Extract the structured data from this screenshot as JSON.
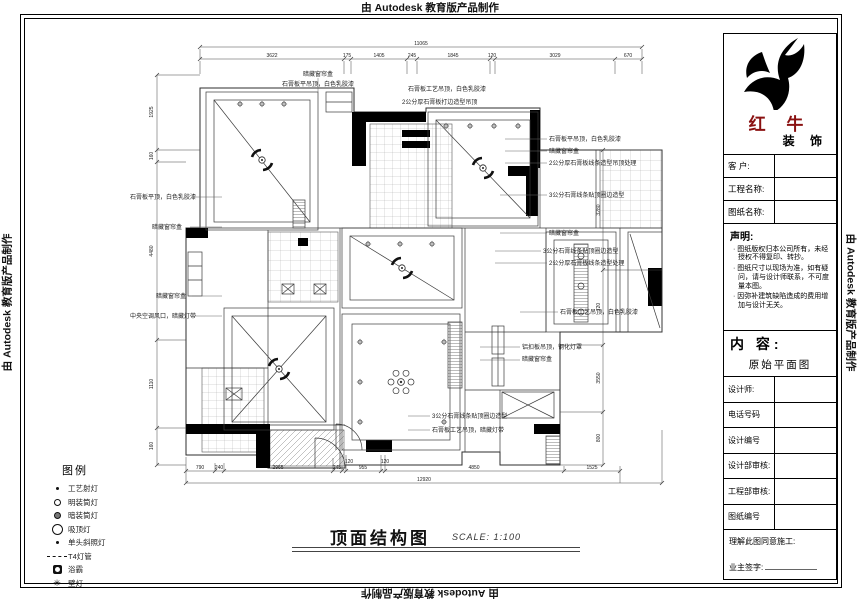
{
  "edge_banner": {
    "text": "由 Autodesk 教育版产品制作"
  },
  "colors": {
    "brand_red": "#8a1111",
    "line": "#3a3a3a",
    "wall": "#000000"
  },
  "title_block": {
    "brand": {
      "name_line1": "红 牛",
      "name_line2": "装 饰"
    },
    "fields": [
      {
        "label": "客  户:"
      },
      {
        "label": "工程名称:"
      },
      {
        "label": "图纸名称:"
      }
    ],
    "statement": {
      "heading": "声明:",
      "items": [
        "图纸版权归本公司所有，未经授权不得复印、转抄。",
        "图纸尺寸以现场为准，如有疑问，请与设计师联系，不可度量本图。",
        "因弥补建筑缺陷造成的费用增加与设计无关。"
      ]
    },
    "content": {
      "heading": "内 容:",
      "value": "原始平面图"
    },
    "rows": [
      "设计师:",
      "电话号码",
      "设计编号",
      "设计部审核:",
      "工程部审核:",
      "图纸编号"
    ],
    "footer": {
      "line1": "理解此图同意施工:",
      "line2": "业主签字:"
    }
  },
  "legend": {
    "title": "图例",
    "items": [
      {
        "icon": "i-dot",
        "label": "工艺射灯"
      },
      {
        "icon": "i-circ",
        "label": "明装筒灯"
      },
      {
        "icon": "i-circ2",
        "label": "暗装筒灯"
      },
      {
        "icon": "i-big",
        "label": "吸顶灯"
      },
      {
        "icon": "i-dot",
        "label": "单头斜照灯"
      },
      {
        "icon": "i-dashdot",
        "label": "T4灯管"
      },
      {
        "icon": "i-fan",
        "label": "浴霸"
      },
      {
        "icon": "i-star",
        "label": "壁灯",
        "glyph": "✳"
      }
    ]
  },
  "drawing_title": {
    "text": "顶面结构图",
    "scale": "SCALE: 1:100"
  },
  "drawing": {
    "texts": [
      {
        "t": "暗藏窗帘盒",
        "x": 318,
        "y": 76,
        "a": "middle"
      },
      {
        "t": "石膏板平吊顶，白色乳胶漆",
        "x": 282,
        "y": 86
      },
      {
        "t": "石膏板工艺吊顶，白色乳胶漆",
        "x": 408,
        "y": 91
      },
      {
        "t": "2公分厚石膏板打边造型吊顶",
        "x": 402,
        "y": 104
      },
      {
        "t": "石膏板平吊顶，白色乳胶漆",
        "x": 549,
        "y": 141
      },
      {
        "t": "暗藏窗帘盒",
        "x": 549,
        "y": 153
      },
      {
        "t": "2公分厚石膏板线条造型吊顶处理",
        "x": 549,
        "y": 165
      },
      {
        "t": "3公分石膏线条贴顶圈边造型",
        "x": 549,
        "y": 197
      },
      {
        "t": "暗藏窗帘盒",
        "x": 549,
        "y": 235
      },
      {
        "t": "3公分石膏线条贴顶圈边造型",
        "x": 543,
        "y": 253
      },
      {
        "t": "2公分厚石膏板线条造型处理",
        "x": 549,
        "y": 265
      },
      {
        "t": "石膏板工艺吊顶，白色乳胶漆",
        "x": 560,
        "y": 314
      },
      {
        "t": "铝扣板吊顶，钢化灯罩",
        "x": 522,
        "y": 349
      },
      {
        "t": "暗藏窗帘盒",
        "x": 522,
        "y": 361
      },
      {
        "t": "石膏板平顶，白色乳胶漆",
        "x": 130,
        "y": 199
      },
      {
        "t": "暗藏窗帘盒",
        "x": 152,
        "y": 229
      },
      {
        "t": "暗藏窗帘盒",
        "x": 156,
        "y": 298
      },
      {
        "t": "中央空调风口，暗藏灯带",
        "x": 130,
        "y": 318
      },
      {
        "t": "3公分石膏线条贴顶圈边造型",
        "x": 432,
        "y": 418
      },
      {
        "t": "石膏板工艺吊顶，暗藏灯带",
        "x": 432,
        "y": 432
      },
      {
        "t": "11065",
        "x": 421,
        "y": 45,
        "s": 5,
        "a": "middle",
        "n": "dim-label"
      },
      {
        "t": "3622",
        "x": 272,
        "y": 57,
        "s": 5,
        "a": "middle",
        "n": "dim-label"
      },
      {
        "t": "175",
        "x": 347,
        "y": 57,
        "s": 5,
        "a": "middle",
        "n": "dim-label"
      },
      {
        "t": "1405",
        "x": 379,
        "y": 57,
        "s": 5,
        "a": "middle",
        "n": "dim-label"
      },
      {
        "t": "245",
        "x": 412,
        "y": 57,
        "s": 5,
        "a": "middle",
        "n": "dim-label"
      },
      {
        "t": "1845",
        "x": 453,
        "y": 57,
        "s": 5,
        "a": "middle",
        "n": "dim-label"
      },
      {
        "t": "120",
        "x": 492,
        "y": 57,
        "s": 5,
        "a": "middle",
        "n": "dim-label"
      },
      {
        "t": "3029",
        "x": 555,
        "y": 57,
        "s": 5,
        "a": "middle",
        "n": "dim-label"
      },
      {
        "t": "670",
        "x": 628,
        "y": 57,
        "s": 5,
        "a": "middle",
        "n": "dim-label"
      },
      {
        "t": "790",
        "x": 200,
        "y": 469,
        "s": 5,
        "a": "middle",
        "n": "dim-label"
      },
      {
        "t": "240",
        "x": 219,
        "y": 469,
        "s": 5,
        "a": "middle",
        "n": "dim-label"
      },
      {
        "t": "2965",
        "x": 278,
        "y": 469,
        "s": 5,
        "a": "middle",
        "n": "dim-label"
      },
      {
        "t": "245",
        "x": 337,
        "y": 469,
        "s": 5,
        "a": "middle",
        "n": "dim-label"
      },
      {
        "t": "120",
        "x": 349,
        "y": 463,
        "s": 5,
        "a": "middle",
        "n": "dim-label"
      },
      {
        "t": "955",
        "x": 363,
        "y": 469,
        "s": 5,
        "a": "middle",
        "n": "dim-label"
      },
      {
        "t": "120",
        "x": 385,
        "y": 463,
        "s": 5,
        "a": "middle",
        "n": "dim-label"
      },
      {
        "t": "4850",
        "x": 474,
        "y": 469,
        "s": 5,
        "a": "middle",
        "n": "dim-label"
      },
      {
        "t": "1525",
        "x": 592,
        "y": 469,
        "s": 5,
        "a": "middle",
        "n": "dim-label"
      },
      {
        "t": "12920",
        "x": 424,
        "y": 481,
        "s": 5,
        "a": "middle",
        "n": "dim-label"
      },
      {
        "t": "1925",
        "x": 153,
        "y": 112,
        "s": 5,
        "a": "middle",
        "r": -90,
        "n": "dim-label"
      },
      {
        "t": "160",
        "x": 153,
        "y": 156,
        "s": 5,
        "a": "middle",
        "r": -90,
        "n": "dim-label"
      },
      {
        "t": "4480",
        "x": 153,
        "y": 251,
        "s": 5,
        "a": "middle",
        "r": -90,
        "n": "dim-label"
      },
      {
        "t": "1110",
        "x": 153,
        "y": 384,
        "s": 5,
        "a": "middle",
        "r": -90,
        "n": "dim-label"
      },
      {
        "t": "160",
        "x": 153,
        "y": 446,
        "s": 5,
        "a": "middle",
        "r": -90,
        "n": "dim-label"
      },
      {
        "t": "3280",
        "x": 600,
        "y": 210,
        "s": 5,
        "a": "middle",
        "r": -90,
        "n": "dim-label"
      },
      {
        "t": "720",
        "x": 600,
        "y": 307,
        "s": 5,
        "a": "middle",
        "r": -90,
        "n": "dim-label"
      },
      {
        "t": "3550",
        "x": 600,
        "y": 378,
        "s": 5,
        "a": "middle",
        "r": -90,
        "n": "dim-label"
      },
      {
        "t": "800",
        "x": 600,
        "y": 438,
        "s": 5,
        "a": "middle",
        "r": -90,
        "n": "dim-label"
      }
    ]
  }
}
